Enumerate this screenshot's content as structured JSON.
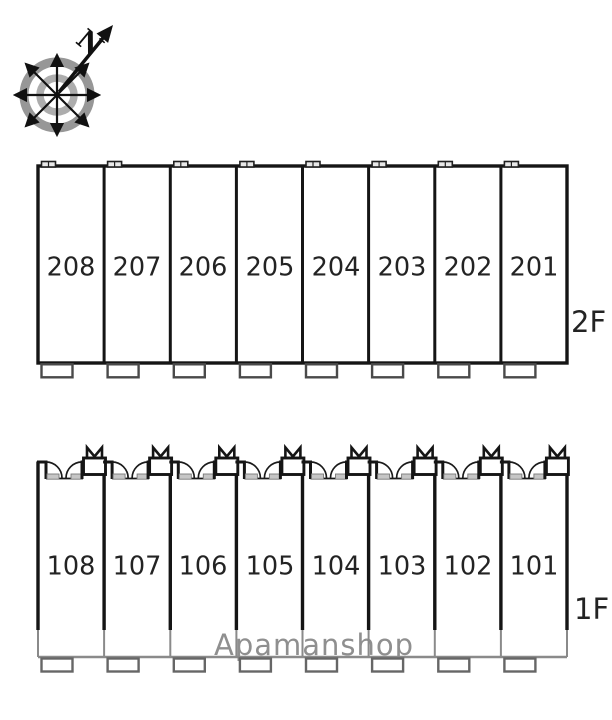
{
  "watermark": "Apamanshop",
  "compass": {
    "north_label": "N"
  },
  "floors": [
    {
      "label": "2F",
      "units": [
        "208",
        "207",
        "206",
        "205",
        "204",
        "203",
        "202",
        "201"
      ]
    },
    {
      "label": "1F",
      "units": [
        "108",
        "107",
        "106",
        "105",
        "104",
        "103",
        "102",
        "101"
      ]
    }
  ],
  "colors": {
    "wall": "#151515",
    "light_gray_line": "#8a8a8a",
    "watermark_gray": "#8f8f8f",
    "unit_text": "#232323",
    "compass_ring_outer": "#979797",
    "compass_ring_inner": "#adadad"
  }
}
